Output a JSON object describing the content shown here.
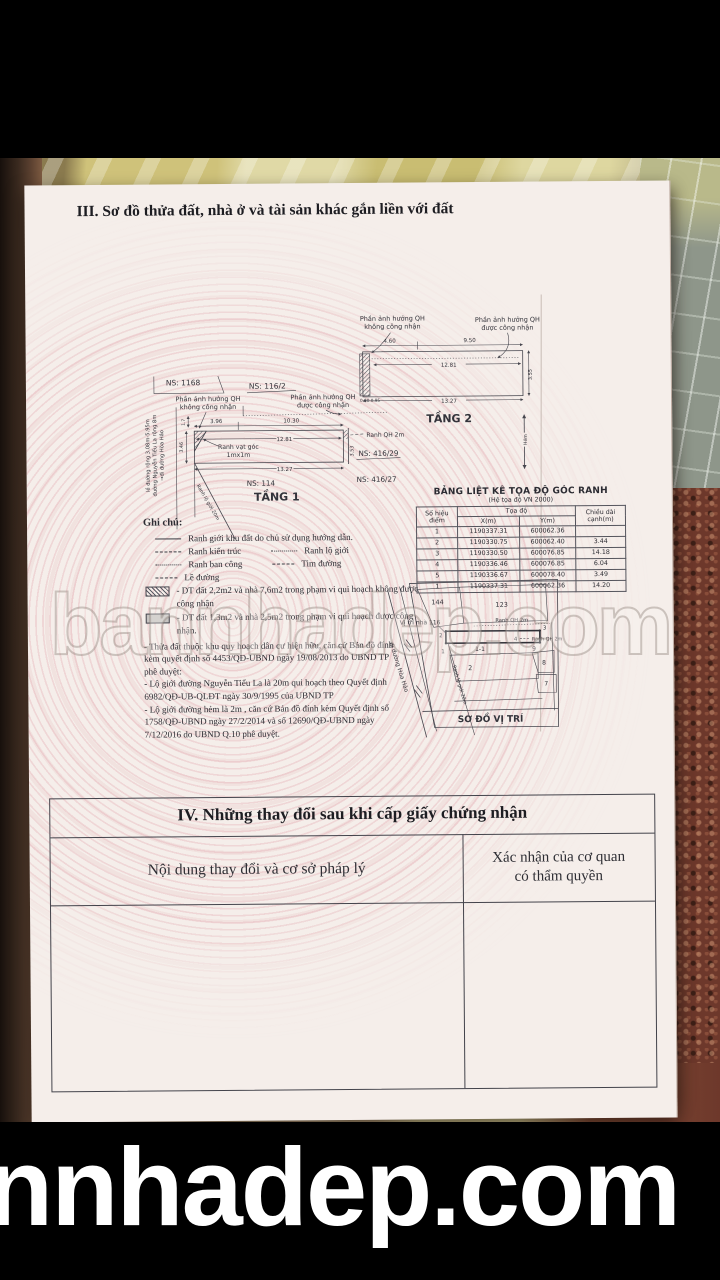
{
  "title_iii": "III. Sơ đồ thửa đất, nhà ở và tài sản khác gắn liền với đất",
  "watermarks": {
    "middle": "bannhadep.com",
    "bottom": "nnhadep.com"
  },
  "floor2": {
    "name": "TẦNG 2",
    "note_left_1": "Phần ảnh hưởng QH",
    "note_left_2": "không công nhận",
    "note_right_1": "Phần ảnh hưởng QH",
    "note_right_2": "được công nhận",
    "dim_top_left": "4.60",
    "dim_top_right": "9.50",
    "dim_inner": "12.81",
    "dim_bottom": "13.27",
    "dim_right": "3.55",
    "dim_corner": "0.90 0.95",
    "alley_label": "Hẻm"
  },
  "floor1": {
    "name": "TẦNG 1",
    "ns_top_left": "NS: 1168",
    "ns_top": "NS: 116/2",
    "ns_bottom": "NS: 114",
    "ns_right_1": "NS: 416/29",
    "ns_right_2": "NS: 416/27",
    "note_left_1": "Phần ảnh hưởng QH",
    "note_left_2": "không công nhận",
    "note_right_1": "Phần ảnh hưởng QH",
    "note_right_2": "được công nhận",
    "dim_top_left": "3.96",
    "dim_top_right": "10.30",
    "dim_inner": "12.81",
    "dim_bottom": "13.27",
    "dim_left": "3.46",
    "dim_right": "3.53",
    "dim_small": "1.7",
    "corner_note_1": "Ranh vạt góc",
    "corner_note_2": "1mx1m",
    "ranh_qh_label": "Ranh QH 2m",
    "street_1": "lề đường rộng 3.08m-5.95m",
    "street_2": "đường Nguyễn Tiểu La rộng 8m",
    "street_3": "→đi đường Hòa Hảo",
    "diag_label": "Ranh lộ giới 20m"
  },
  "legend": {
    "title": "Ghi chú:",
    "row1": {
      "label": "Ranh giới khu đất do chủ sử dụng hướng dẫn."
    },
    "row2": {
      "label": "Ranh kiến trúc",
      "label2": "Ranh lộ giới"
    },
    "row3": {
      "label": "Ranh ban công",
      "label2": "Tim đường"
    },
    "row4": {
      "label": "Lề đường"
    },
    "row5": {
      "label": "- DT đất 2,2m2 và nhà 7,6m2  trong phạm vi qui hoạch không được công nhận"
    },
    "row6": {
      "label": "- DT đất 1,3m2 và nhà 2,5m2  trong phạm vi qui hoạch được công nhận."
    },
    "notes": "- Thửa đất thuộc khu quy hoạch dân cư hiện hữu, căn cứ Bản đồ đính\nkèm quyết định số 4453/QĐ-UBND ngày 19/08/2013 do UBND TP\nphê duyệt:\n- Lộ giới đường Nguyễn Tiểu La là 20m qui hoạch theo Quyết định\n6982/QĐ-UB-QLĐT ngày 30/9/1995 của UBND TP\n- Lộ giới đường hẻm là 2m , căn cứ  Bản đồ đính kèm Quyết định số\n1758/QĐ-UBND ngày 27/2/2014 và số 12690/QĐ-UBND ngày\n7/12/2016 do UBND Q.10 phê duyệt."
  },
  "coord_table": {
    "title": "BẢNG LIỆT KÊ TỌA ĐỘ GÓC RANH",
    "subtitle": "(Hệ tọa độ VN 2000)",
    "col_point": "Số hiệu\nđiểm",
    "col_coord": "Tọa độ",
    "col_x": "X(m)",
    "col_y": "Y(m)",
    "col_len": "Chiều dài\ncạnh(m)",
    "rows": [
      {
        "p": "1",
        "x": "1190337.31",
        "y": "600062.36",
        "d": ""
      },
      {
        "p": "2",
        "x": "1190330.75",
        "y": "600062.40",
        "d": "3.44"
      },
      {
        "p": "3",
        "x": "1190330.50",
        "y": "600076.85",
        "d": "14.18"
      },
      {
        "p": "4",
        "x": "1190336.46",
        "y": "600076.85",
        "d": "6.04"
      },
      {
        "p": "5",
        "x": "1190336.67",
        "y": "600078.40",
        "d": "3.49"
      },
      {
        "p": "1",
        "x": "1190337.31",
        "y": "600062.36",
        "d": "14.20"
      }
    ]
  },
  "location_map": {
    "title": "SƠ ĐỒ VỊ TRÍ",
    "parcel_144": "144",
    "parcel_123": "123",
    "subject": "Vị trí nhà 116",
    "ranh_qh_top": "Ranh QH 2m",
    "ranh_qh_right": "Ranh QH 2m",
    "pt1": "1",
    "pt2": "2",
    "pt3": "3",
    "pt4": "4",
    "parcel_11": "1-1",
    "parcel_9": "9",
    "parcel_2": "2",
    "parcel_8": "8",
    "parcel_7": "7",
    "road": "đi đường Hòa Hảo",
    "diag": "Ranh lộ giới 20m"
  },
  "section4": {
    "title": "IV. Những thay đổi sau khi cấp giấy chứng nhận",
    "col_left": "Nội dung thay đổi và cơ sở pháp lý",
    "col_right": "Xác nhận của cơ quan\ncó thẩm quyền"
  }
}
